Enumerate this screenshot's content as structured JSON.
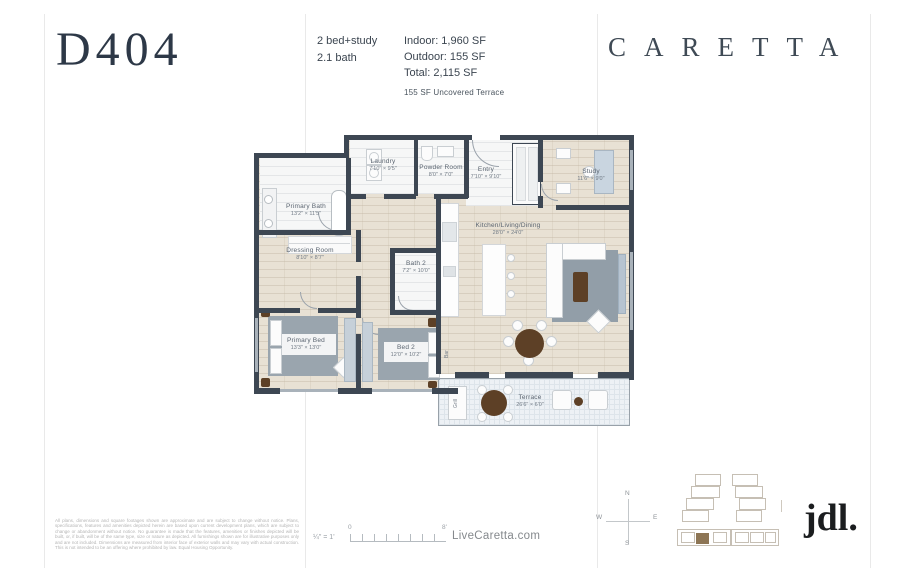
{
  "header": {
    "unit": "D404",
    "spec_line1": "2 bed+study",
    "spec_line2": "2.1 bath",
    "indoor": "Indoor: 1,960 SF",
    "outdoor": "Outdoor: 155 SF",
    "total": "Total: 2,115 SF",
    "area_note": "155 SF Uncovered Terrace",
    "brand": "CARETTA"
  },
  "rooms": [
    {
      "name": "Primary Bath",
      "dims": "13'2\" × 11'5\""
    },
    {
      "name": "Laundry",
      "dims": "7'10\" × 9'5\""
    },
    {
      "name": "Powder Room",
      "dims": "8'0\" × 7'0\""
    },
    {
      "name": "Entry",
      "dims": "7'10\" × 9'10\""
    },
    {
      "name": "Study",
      "dims": "11'6\" × 9'0\""
    },
    {
      "name": "Kitchen/Living/Dining",
      "dims": "28'0\" × 24'0\""
    },
    {
      "name": "Dressing Room",
      "dims": "8'10\" × 8'7\""
    },
    {
      "name": "Bath 2",
      "dims": "7'2\" × 10'0\""
    },
    {
      "name": "Primary Bed",
      "dims": "13'3\" × 13'0\""
    },
    {
      "name": "Bed 2",
      "dims": "12'0\" × 10'2\""
    },
    {
      "name": "Terrace",
      "dims": "26'6\" × 6'0\""
    }
  ],
  "plan_labels": {
    "bar": "Bar",
    "grill": "Grill"
  },
  "compass": {
    "n": "N",
    "s": "S",
    "e": "E",
    "w": "W"
  },
  "footer": {
    "disclaimer": "All plans, dimensions and square footages shown are approximate and are subject to change without notice. Plans, specifications, features and amenities depicted herein are based upon current development plans, which are subject to change or abandonment without notice. No guarantee is made that the features, amenities or finishes depicted will be built, or, if built, will be of the same type, size or nature as depicted. All furnishings shown are for illustrative purposes only and are not included. Dimensions are measured from interior face of exterior walls and may vary with actual construction. This is not intended to be an offering where prohibited by law. Equal Housing Opportunity.",
    "scale_label": "¼\" = 1'",
    "scale_start": "0",
    "scale_end": "8'",
    "website": "LiveCaretta.com",
    "logo": "jdl."
  },
  "colors": {
    "wall": "#3d4753",
    "floor_beige": "#e8e1d4",
    "floor_wet": "#f6f7f7",
    "terrace": "#edf1f5",
    "rug": "#929ea8",
    "accent_brown": "#5d4026",
    "keyplan_highlight": "#8d7555",
    "title_navy": "#2d3847"
  }
}
